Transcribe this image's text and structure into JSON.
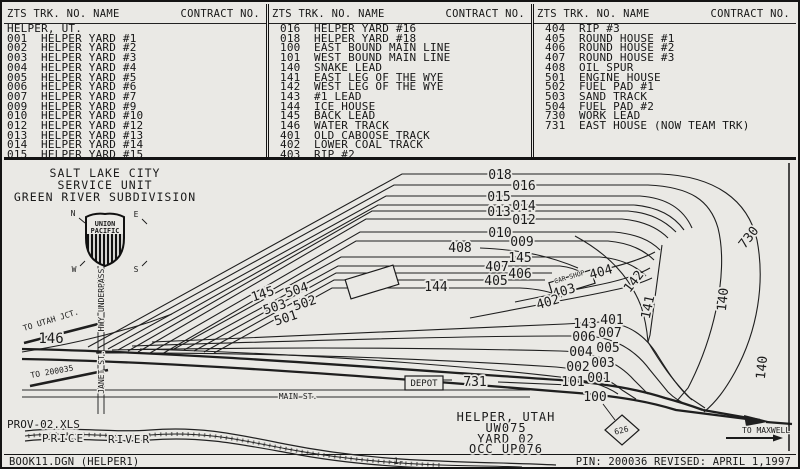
{
  "colors": {
    "paper": "#eae9e5",
    "ink": "#1b1b1b"
  },
  "table": {
    "header_left": "ZTS TRK. NO. NAME",
    "header_right": "CONTRACT NO.",
    "columns": [
      {
        "region": "HELPER, UT.",
        "rows": [
          [
            "001",
            "HELPER YARD #1"
          ],
          [
            "002",
            "HELPER YARD #2"
          ],
          [
            "003",
            "HELPER YARD #3"
          ],
          [
            "004",
            "HELPER YARD #4"
          ],
          [
            "005",
            "HELPER YARD #5"
          ],
          [
            "006",
            "HELPER YARD #6"
          ],
          [
            "007",
            "HELPER YARD #7"
          ],
          [
            "009",
            "HELPER YARD #9"
          ],
          [
            "010",
            "HELPER YARD #10"
          ],
          [
            "012",
            "HELPER YARD #12"
          ],
          [
            "013",
            "HELPER YARD #13"
          ],
          [
            "014",
            "HELPER YARD #14"
          ],
          [
            "015",
            "HELPER YARD #15"
          ]
        ]
      },
      {
        "rows": [
          [
            "016",
            "HELPER YARD #16"
          ],
          [
            "018",
            "HELPER YARD #18"
          ],
          [
            "100",
            "EAST BOUND MAIN LINE"
          ],
          [
            "101",
            "WEST BOUND MAIN LINE"
          ],
          [
            "140",
            "SNAKE LEAD"
          ],
          [
            "141",
            "EAST LEG OF THE WYE"
          ],
          [
            "142",
            "WEST LEG OF THE WYE"
          ],
          [
            "143",
            "#1 LEAD"
          ],
          [
            "144",
            "ICE HOUSE"
          ],
          [
            "145",
            "BACK LEAD"
          ],
          [
            "146",
            "WATER TRACK"
          ],
          [
            "401",
            "OLD CABOOSE TRACK"
          ],
          [
            "402",
            "LOWER COAL TRACK"
          ],
          [
            "403",
            "RIP #2"
          ]
        ]
      },
      {
        "rows": [
          [
            "404",
            "RIP #3"
          ],
          [
            "405",
            "ROUND HOUSE #1"
          ],
          [
            "406",
            "ROUND HOUSE #2"
          ],
          [
            "407",
            "ROUND HOUSE #3"
          ],
          [
            "408",
            "OIL SPUR"
          ],
          [
            "501",
            "ENGINE HOUSE"
          ],
          [
            "502",
            "FUEL PAD #1"
          ],
          [
            "503",
            "SAND TRACK"
          ],
          [
            "504",
            "FUEL PAD #2"
          ],
          [
            "730",
            "WORK LEAD"
          ],
          [
            "731",
            "EAST HOUSE (NOW TEAM TRK)"
          ]
        ]
      }
    ]
  },
  "diagram": {
    "title": {
      "line1": "SALT LAKE CITY",
      "line2": "SERVICE UNIT",
      "line3": "GREEN RIVER SUBDIVISION"
    },
    "logo": {
      "line1": "UNION",
      "line2": "PACIFIC"
    },
    "compass": {
      "n": "N",
      "e": "E",
      "w": "W",
      "s": "S"
    },
    "streets": {
      "hwy": "HWY UNDERPASS",
      "janet": "JANET ST.",
      "main": "MAIN ST."
    },
    "river": {
      "word1": "PRICE",
      "word2": "RIVER"
    },
    "notes": {
      "prov": "PROV-02.XLS",
      "to_utah": "TO UTAH JCT.",
      "to_200035": "TO 200035",
      "to_maxwell": "TO MAXWELL",
      "depot": "DEPOT",
      "car_shop": "CAR SHOP",
      "milepost": "626"
    },
    "location": {
      "line1": "HELPER, UTAH",
      "line2": "UW075",
      "line3": "YARD 02",
      "line4": "OCC UP076"
    },
    "labels": {
      "t018": "018",
      "t016": "016",
      "t015": "015",
      "t014": "014",
      "t013": "013",
      "t012": "012",
      "t010": "010",
      "t009": "009",
      "t408": "408",
      "t145e": "145",
      "t407": "407",
      "t406": "406",
      "t405": "405",
      "t144": "144",
      "t404": "404",
      "t403": "403",
      "t402": "402",
      "t142": "142",
      "t141": "141",
      "t140a": "140",
      "t140b": "140",
      "t730": "730",
      "t143": "143",
      "t401": "401",
      "t006": "006",
      "t007": "007",
      "t004": "004",
      "t005": "005",
      "t002": "002",
      "t003": "003",
      "t101": "101",
      "t001": "001",
      "t100": "100",
      "t146": "146",
      "t145w": "145",
      "t504": "504",
      "t503": "503",
      "t502": "502",
      "t501": "501",
      "t731": "731"
    }
  },
  "footer": {
    "left": "BOOK11.DGN (HELPER1)",
    "right": "PIN: 200036 REVISED: APRIL 1,1997",
    "page": "-1-"
  }
}
